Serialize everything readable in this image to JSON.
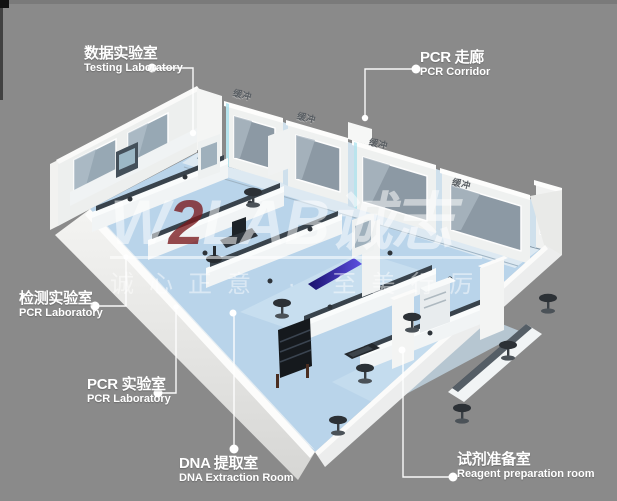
{
  "background_color": "#8a8a8a",
  "watermark": {
    "brand_w": "W",
    "brand_2": "2",
    "brand_rest": "LAB",
    "brand_cn": "诚志",
    "slogan": "诚心正意 · 至美行厉",
    "brand_color": "#ffffff",
    "accent_color": "#7a181c"
  },
  "room_labels": [
    {
      "id": "testing-laboratory",
      "cn": "数据实验室",
      "en": "Testing Laboratory"
    },
    {
      "id": "pcr-corridor",
      "cn": "PCR 走廊",
      "en": "PCR Corridor"
    },
    {
      "id": "inspection-lab",
      "cn": "检测实验室",
      "en": "PCR Laboratory"
    },
    {
      "id": "pcr-laboratory",
      "cn": "PCR 实验室",
      "en": "PCR Laboratory"
    },
    {
      "id": "dna-extraction",
      "cn": "DNA 提取室",
      "en": "DNA Extraction Room"
    },
    {
      "id": "reagent-room",
      "cn": "试剂准备室",
      "en": "Reagent preparation room"
    }
  ],
  "wall_tags": [
    "缓冲",
    "缓冲",
    "缓冲",
    "缓冲"
  ],
  "palette": {
    "floor_blue": "#b9d4ea",
    "floor_light": "#dde9f2",
    "wall_white": "#eff1f0",
    "window_glass": "#8c99a4",
    "bench_shelf": "#39434c",
    "purple_accent": "#4a3cd6",
    "label_text": "#ffffff"
  }
}
